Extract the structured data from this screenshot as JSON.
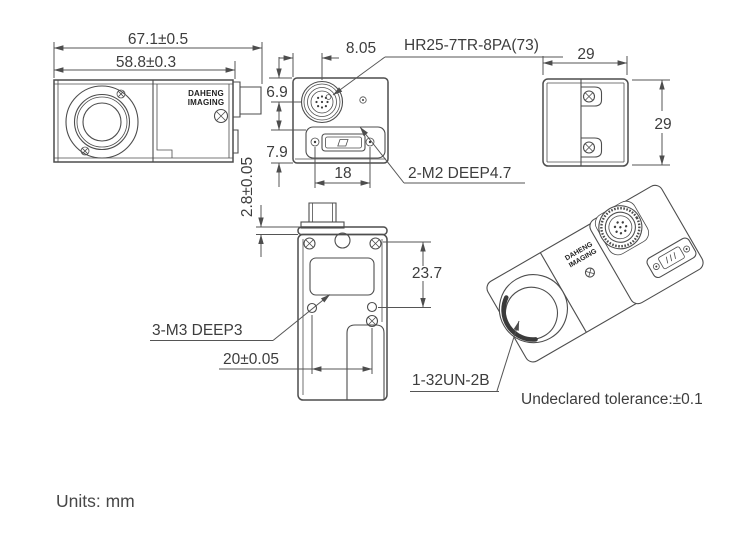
{
  "drawing": {
    "title": "industrial-camera-dimensional-drawing",
    "units_note": "Units: mm",
    "tolerance_note": "Undeclared tolerance:±0.1",
    "colors": {
      "line": "#4d4d4d",
      "text": "#3d3d3d",
      "background": "#ffffff"
    },
    "brand": {
      "line1": "DAHENG",
      "line2": "IMAGING"
    },
    "side_view": {
      "dim_overall_length": "67.1±0.5",
      "dim_body_length": "58.8±0.3"
    },
    "rear_view": {
      "dim_connector_x": "8.05",
      "dim_connector_y": "6.9",
      "dim_port_y": "7.9",
      "dim_screw_spacing": "18",
      "label_connector": "HR25-7TR-8PA(73)",
      "label_screws": "2-M2 DEEP4.7"
    },
    "top_view": {
      "dim_width": "29",
      "dim_height": "29"
    },
    "bottom_view": {
      "dim_flange_thickness": "2.8±0.05",
      "dim_hole_offset": "23.7",
      "dim_hole_spacing": "20±0.05",
      "label_holes": "3-M3 DEEP3"
    },
    "iso_view": {
      "label_mount_thread": "1-32UN-2B"
    }
  }
}
